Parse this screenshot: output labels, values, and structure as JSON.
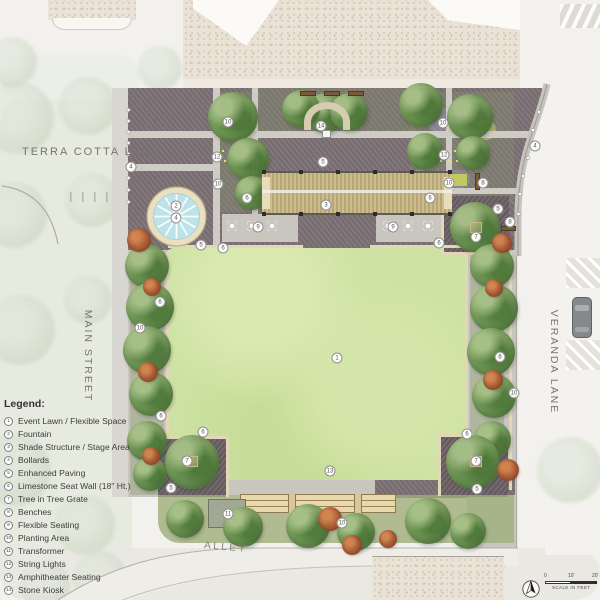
{
  "streets": {
    "top_left": "TERRA COTTA LANE",
    "left": "MAIN STREET",
    "right": "VERANDA LANE",
    "bottom": "ALLEY"
  },
  "legend": {
    "title": "Legend:",
    "items": [
      {
        "num": "1",
        "label": "Event Lawn / Flexible Space"
      },
      {
        "num": "2",
        "label": "Fountain"
      },
      {
        "num": "3",
        "label": "Shade Structure / Stage Area"
      },
      {
        "num": "4",
        "label": "Bollards"
      },
      {
        "num": "5",
        "label": "Enhanced Paving"
      },
      {
        "num": "6",
        "label": "Limestone Seat Wall (18\" Ht.)"
      },
      {
        "num": "7",
        "label": "Tree in Tree Grate"
      },
      {
        "num": "8",
        "label": "Benches"
      },
      {
        "num": "9",
        "label": "Flexible Seating"
      },
      {
        "num": "10",
        "label": "Planting Area"
      },
      {
        "num": "11",
        "label": "Transformer"
      },
      {
        "num": "12",
        "label": "String Lights"
      },
      {
        "num": "13",
        "label": "Amphitheater Seating"
      },
      {
        "num": "14",
        "label": "Stone Kiosk"
      }
    ]
  },
  "scale_bar": {
    "zero": "0",
    "ten": "10'",
    "twenty": "20'",
    "caption": "SCALE IN FEET"
  },
  "markers": [
    {
      "n": "4"
    },
    {
      "n": "10"
    },
    {
      "n": "14"
    },
    {
      "n": "12"
    },
    {
      "n": "5"
    },
    {
      "n": "10"
    },
    {
      "n": "6"
    },
    {
      "n": "3"
    },
    {
      "n": "2"
    },
    {
      "n": "4"
    },
    {
      "n": "10"
    },
    {
      "n": "12"
    },
    {
      "n": "4"
    },
    {
      "n": "10"
    },
    {
      "n": "8"
    },
    {
      "n": "6"
    },
    {
      "n": "5"
    },
    {
      "n": "8"
    },
    {
      "n": "7"
    },
    {
      "n": "6"
    },
    {
      "n": "9"
    },
    {
      "n": "9"
    },
    {
      "n": "6"
    },
    {
      "n": "5"
    },
    {
      "n": "6"
    },
    {
      "n": "10"
    },
    {
      "n": "6"
    },
    {
      "n": "6"
    },
    {
      "n": "10"
    },
    {
      "n": "1"
    },
    {
      "n": "13"
    },
    {
      "n": "6"
    },
    {
      "n": "7"
    },
    {
      "n": "5"
    },
    {
      "n": "6"
    },
    {
      "n": "7"
    },
    {
      "n": "5"
    },
    {
      "n": "11"
    },
    {
      "n": "10"
    }
  ],
  "colors": {
    "paving": "#7c7174",
    "corner_paving": "#6c6266",
    "lawn": "#cde2a2",
    "water": "#bce3e8",
    "fountain_ring": "#eadfc0",
    "canopy_green": "#7fa061",
    "accent_orange": "#b4633a",
    "walk_gray": "#c9c6c0",
    "shade_slats": "#c4b284",
    "amphitheater": "#e8d9ad"
  }
}
